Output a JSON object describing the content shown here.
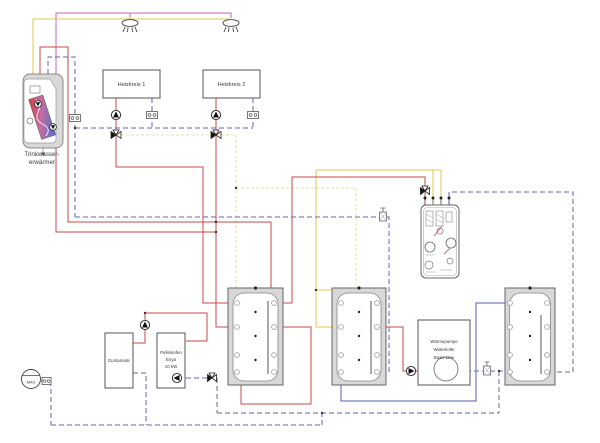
{
  "diagram": {
    "type": "hydraulic-heating-schematic",
    "labels": {
      "dhw_line1": "Trinkwasser-",
      "dhw_line2": "erwärmer",
      "heizkreis1": "Heizkreis 1",
      "heizkreis2": "Heizkreis 2",
      "boiler": "Guntamatic",
      "stove_line1": "Pelletsofen",
      "stove_line2": "Enya",
      "stove_line3": "10 kW",
      "heatpump_line1": "Wärmepumpe",
      "heatpump_line2": "Waterkotte",
      "heatpump_line3": "Basic Line",
      "expansion_vessel": "MAG"
    },
    "components": [
      "domestic-hot-water-tank",
      "shower-tap-1",
      "shower-tap-2",
      "heating-circuit-1",
      "heating-circuit-2",
      "boiler-guntamatic",
      "pellet-stove-enya",
      "buffer-tank-1",
      "buffer-tank-2",
      "buffer-tank-3",
      "heat-pump-waterkotte",
      "fresh-water-module",
      "expansion-vessel-mag",
      "pumps",
      "mixing-valves",
      "shut-off-fittings"
    ],
    "colors": {
      "supply_red": "#c94a4a",
      "hot_water_magenta": "#ca5fc6",
      "cold_water_yellow": "#e2c84b",
      "sensor_dashed_yellow": "#efdf9f",
      "return_dashed_blue": "#6565ad",
      "source_solid_blue": "#5b5bb5",
      "tank_fill": "#d8d8d8",
      "outline_gray": "#555555"
    }
  }
}
